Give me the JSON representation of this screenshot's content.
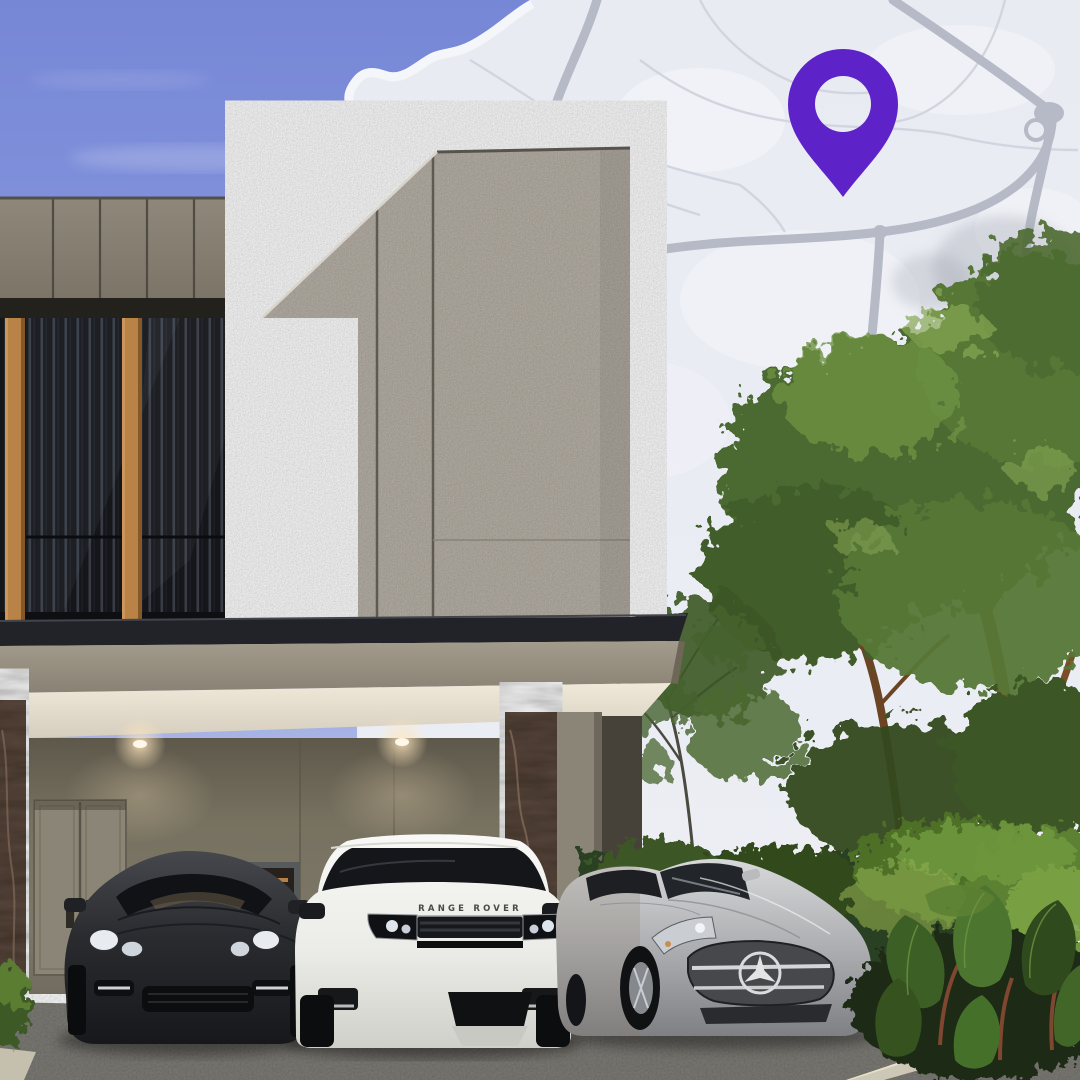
{
  "map": {
    "pin_color": "#5d23c9",
    "background_color": "#e9ebf3",
    "road_color": "#b6bac6",
    "minor_road_color": "#d0d4de",
    "land_patch_color": "#f4f5f9"
  },
  "vehicles": {
    "range_rover_badge": "RANGE ROVER",
    "porsche_color": "#2c2d30",
    "range_rover_color": "#f2f2ef",
    "mercedes_color": "#aaacaf"
  },
  "building": {
    "fascia_color": "#8a8376",
    "granite_color": "#bab4aa",
    "louver_color": "#15161a",
    "wood_trim_color": "#b98348",
    "roof_color": "#222328",
    "ceiling_color": "#e9e2d4",
    "wall_color": "#756f60",
    "marble_color": "#5d4a3e"
  },
  "environment": {
    "sky_top_color": "#7e90dc",
    "sky_horizon_color": "#c7cfec",
    "tree_color": "#4c6a31",
    "hedge_color": "#2c4120",
    "driveway_color": "#918e88",
    "curb_color": "#cdc7b6"
  }
}
